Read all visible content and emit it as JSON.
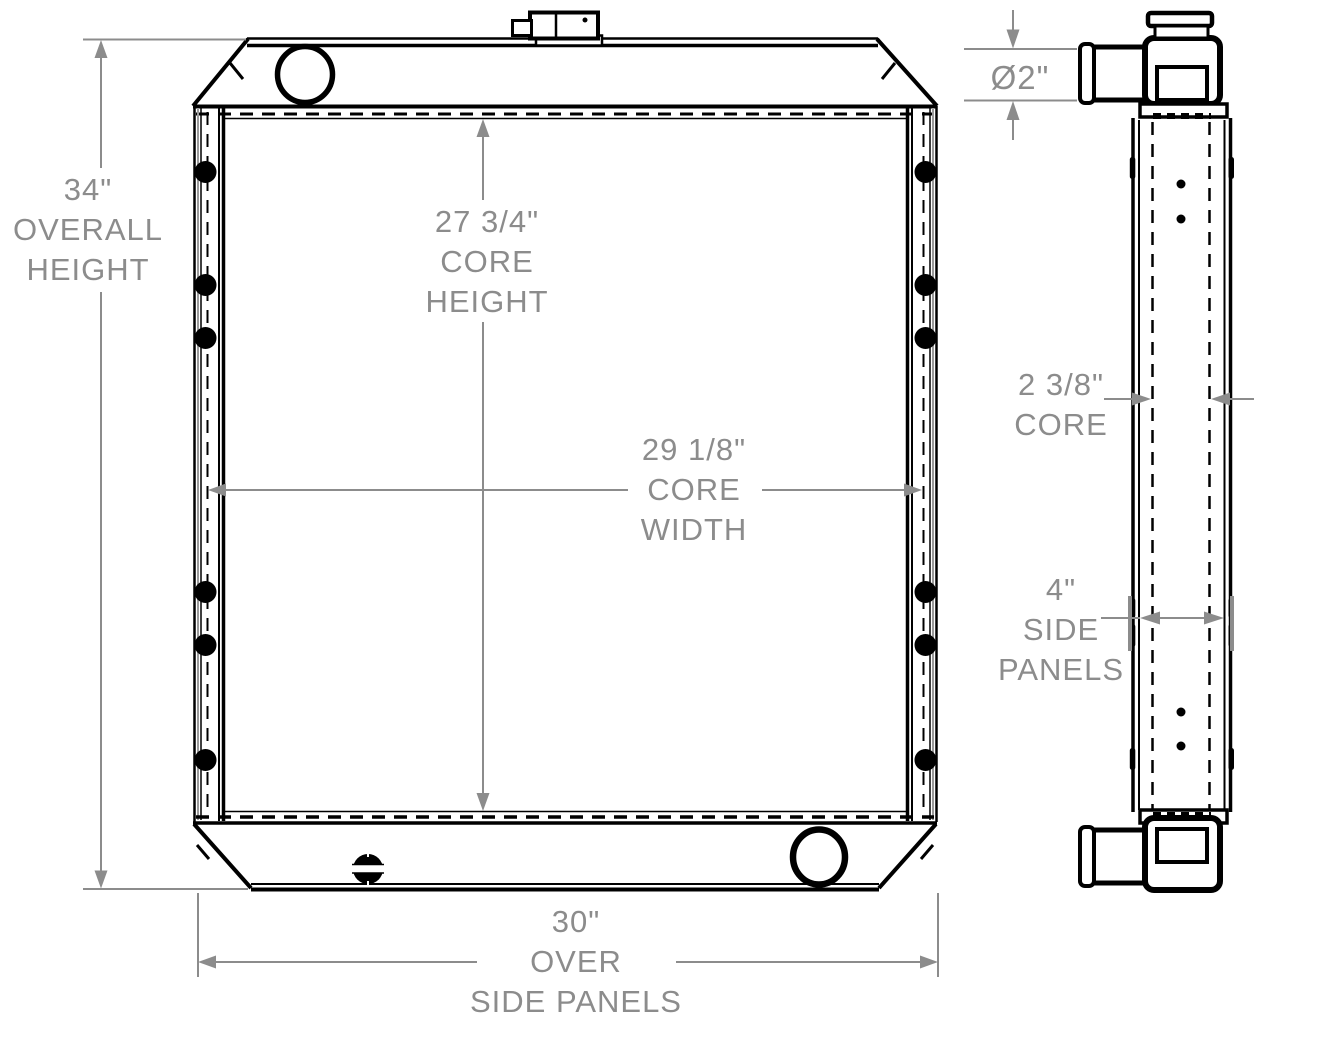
{
  "dimensions": {
    "overall_height": {
      "value": "34\"",
      "line2": "OVERALL",
      "line3": "HEIGHT"
    },
    "core_height": {
      "value": "27 3/4\"",
      "line2": "CORE",
      "line3": "HEIGHT"
    },
    "core_width": {
      "value": "29 1/8\"",
      "line2": "CORE",
      "line3": "WIDTH"
    },
    "over_side_panels": {
      "value": "30\"",
      "line2": "OVER",
      "line3": "SIDE PANELS"
    },
    "tube_diameter": {
      "value": "Ø2\""
    },
    "core_thickness": {
      "value": "2 3/8\"",
      "line2": "CORE"
    },
    "side_panels": {
      "value": "4\"",
      "line2": "SIDE",
      "line3": "PANELS"
    }
  },
  "colors": {
    "drawing_line": "#000000",
    "dimension": "#8c8c8c",
    "background": "#ffffff"
  }
}
